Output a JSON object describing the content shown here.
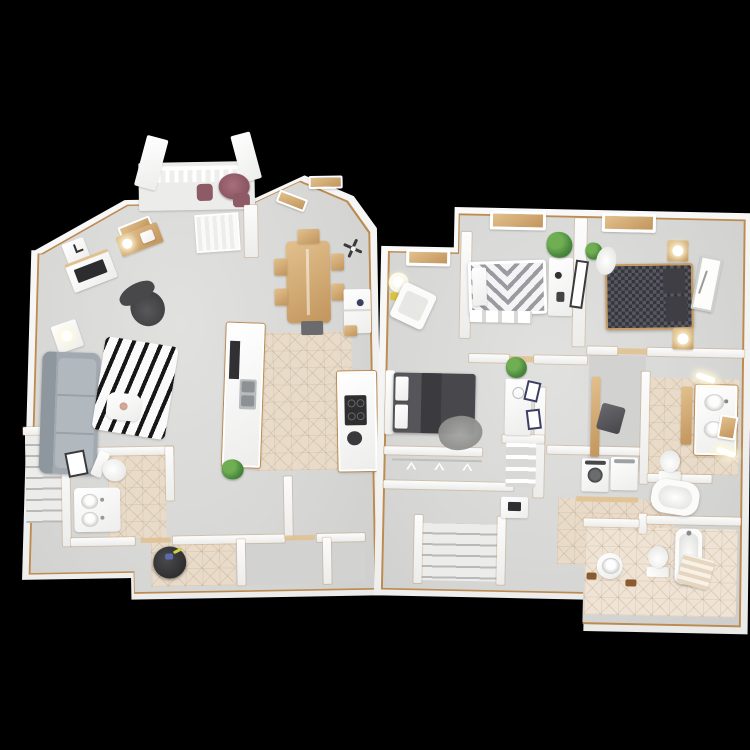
{
  "palette": {
    "bg": "#000000",
    "wall": "#f6f6f5",
    "floor": "#d7d7d5",
    "tile": "#e8dbc9",
    "trim": "#bd8b50",
    "wood": "#e2c08d",
    "wood_2": "#c2955c",
    "sofa": "#a2a9b0",
    "charcoal": "#3c3c3e",
    "bed_dark": "#4a4a4e",
    "mauve": "#92606c",
    "plant": "#4d8c3f",
    "navy": "#3c3f63",
    "steel": "#b9bcbe"
  },
  "render": {
    "style": "3d-top-down-floor-plan",
    "background": "#000000",
    "plan_count": 2
  },
  "first_floor": {
    "id": "first-floor-plan",
    "rooms": [
      "balcony",
      "living-room",
      "dining-area",
      "kitchen",
      "half-bath",
      "entry",
      "closet",
      "staircase"
    ],
    "furniture": [
      "bistro-table",
      "bistro-chair",
      "balcony-railing",
      "balcony-posts",
      "sliding-door-blinds",
      "window-sill",
      "wall-clock",
      "corner-desk",
      "desk-lamp",
      "tv-console",
      "television",
      "accent-chair",
      "side-table",
      "table-lamp",
      "sofa",
      "zebra-rug",
      "coffee-table",
      "dining-table",
      "dining-chair",
      "ceiling-fan",
      "refrigerator",
      "counter-vase",
      "kitchen-island",
      "dishwasher",
      "double-sink",
      "kitchen-counter",
      "cooktop",
      "potted-plant",
      "toilet",
      "bathroom-vanity",
      "framed-art",
      "entry-pouf"
    ]
  },
  "second_floor": {
    "id": "second-floor-plan",
    "rooms": [
      "bedroom-one",
      "bedroom-two",
      "bedroom-three",
      "master-bathroom",
      "hall-bathroom",
      "walk-in-closet",
      "hanger-closet",
      "shelf-closet",
      "laundry-closet",
      "hallway",
      "staircase"
    ],
    "furniture": [
      "chevron-bed",
      "footboard-bench",
      "dresser",
      "leaning-mirror",
      "potted-plant",
      "houndstooth-bed",
      "nightstand",
      "bedside-lamp",
      "sheepskin-rug",
      "wall-art",
      "reading-chair",
      "round-side-table",
      "gray-bed",
      "fuzzy-throw",
      "navy-frame",
      "clothes-hamper",
      "closet-shelf",
      "hangers",
      "washer",
      "dryer",
      "double-vanity",
      "vanity-lights",
      "toilet",
      "garden-tub",
      "bathtub",
      "pedestal-sink",
      "striped-bath-rug",
      "stair-desk"
    ]
  }
}
